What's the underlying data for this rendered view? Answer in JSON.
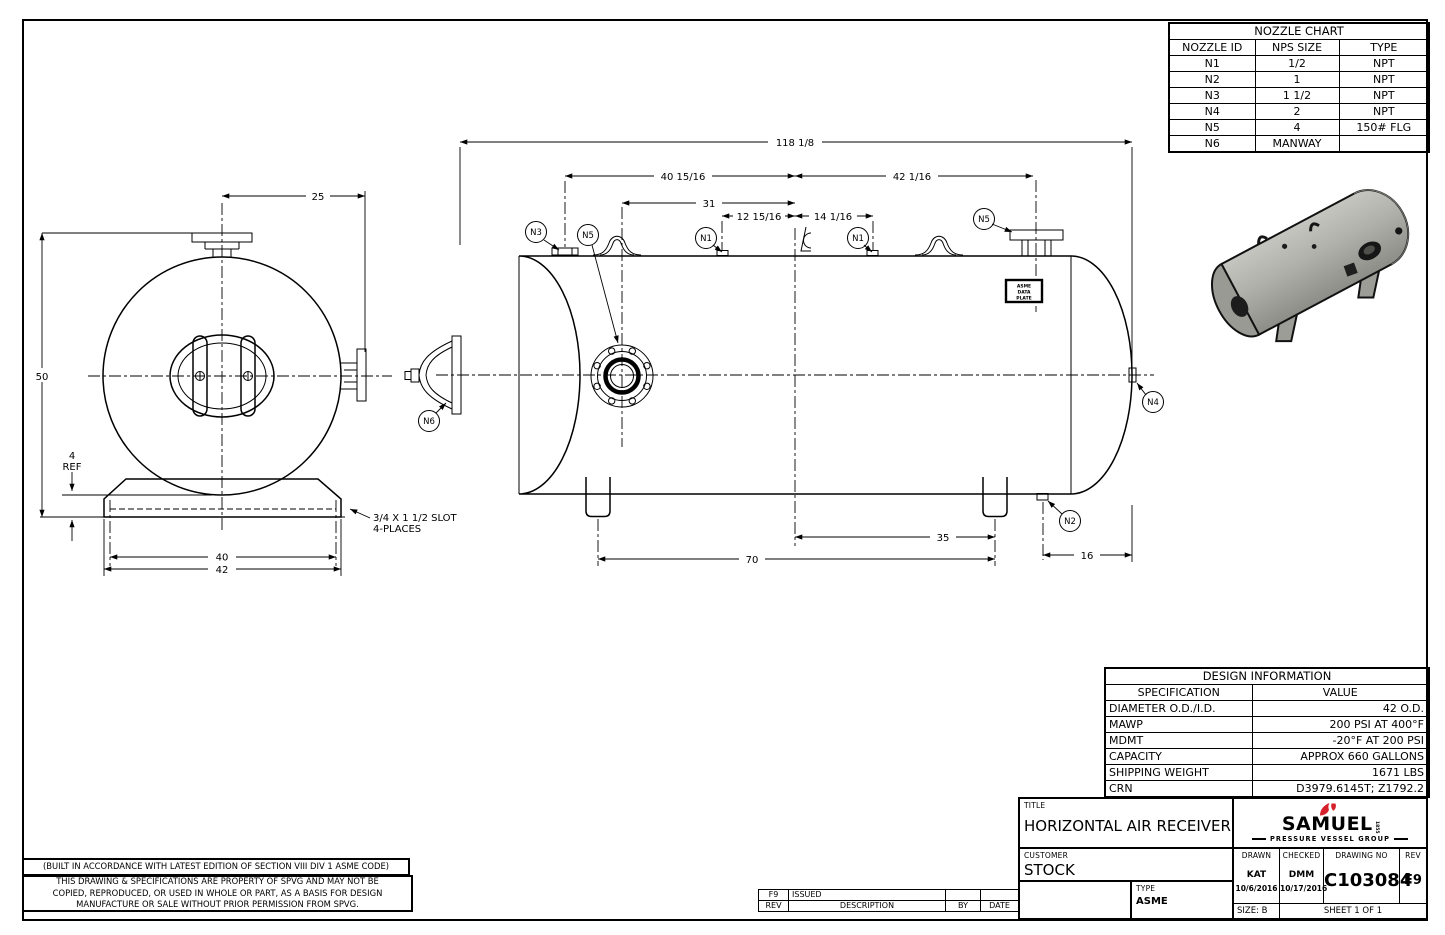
{
  "colors": {
    "brand_red": "#d6202a",
    "tank_gray": "#a6a6a1",
    "line": "#000000"
  },
  "nozzle_chart": {
    "title": "NOZZLE CHART",
    "headers": [
      "NOZZLE ID",
      "NPS SIZE",
      "TYPE"
    ],
    "rows": [
      [
        "N1",
        "1/2",
        "NPT"
      ],
      [
        "N2",
        "1",
        "NPT"
      ],
      [
        "N3",
        "1 1/2",
        "NPT"
      ],
      [
        "N4",
        "2",
        "NPT"
      ],
      [
        "N5",
        "4",
        "150# FLG"
      ],
      [
        "N6",
        "MANWAY",
        ""
      ]
    ]
  },
  "design_info": {
    "title": "DESIGN INFORMATION",
    "headers": [
      "SPECIFICATION",
      "VALUE"
    ],
    "rows": [
      [
        "DIAMETER O.D./I.D.",
        "42 O.D."
      ],
      [
        "MAWP",
        "200 PSI AT 400°F"
      ],
      [
        "MDMT",
        "-20°F AT 200 PSI"
      ],
      [
        "CAPACITY",
        "APPROX 660 GALLONS"
      ],
      [
        "SHIPPING WEIGHT",
        "1671 LBS"
      ],
      [
        "CRN",
        "D3979.6145T; Z1792.2"
      ]
    ]
  },
  "title_block": {
    "title_label": "TITLE",
    "title": "HORIZONTAL AIR RECEIVER",
    "customer_label": "CUSTOMER",
    "customer": "STOCK",
    "type_label": "TYPE",
    "type": "ASME",
    "drawn_label": "DRAWN",
    "drawn_by": "KAT",
    "drawn_date": "10/6/2016",
    "checked_label": "CHECKED",
    "checked_by": "DMM",
    "checked_date": "10/17/2016",
    "drawing_no_label": "DRAWING NO",
    "drawing_no": "C103084",
    "rev_label": "REV",
    "rev": "F9",
    "size": "SIZE: B",
    "sheet": "SHEET 1  OF 1"
  },
  "logo": {
    "name": "SAMUEL",
    "year": "1855",
    "subtitle": "PRESSURE VESSEL GROUP"
  },
  "revision_table": {
    "headers": [
      "REV",
      "DESCRIPTION",
      "BY",
      "DATE"
    ],
    "rows": [
      [
        "F9",
        "ISSUED",
        "",
        ""
      ]
    ]
  },
  "notes": {
    "code_note": "(BUILT IN ACCORDANCE WITH LATEST EDITION OF SECTION VIII DIV 1 ASME CODE)",
    "property_note_1": "THIS DRAWING & SPECIFICATIONS ARE PROPERTY OF SPVG AND MAY NOT BE",
    "property_note_2": "COPIED, REPRODUCED, OR USED IN WHOLE OR PART, AS A BASIS FOR DESIGN",
    "property_note_3": "MANUFACTURE OR SALE WITHOUT PRIOR PERMISSION FROM SPVG."
  },
  "drawing": {
    "end_view": {
      "dim_width_top": "25",
      "dim_height": "50",
      "dim_ref_val": "4",
      "dim_ref_label": "REF",
      "dim_slot_span": "40",
      "dim_base": "42",
      "slot_note_1": "3/4 X 1 1/2 SLOT",
      "slot_note_2": "4-PLACES"
    },
    "side_view": {
      "dim_overall": "118 1/8",
      "dim_left_to_cl": "40 15/16",
      "dim_n5_to_cl": "31",
      "dim_n1l_to_cl": "12 15/16",
      "dim_cl_to_n1r": "14 1/16",
      "dim_cl_to_n5r": "42 1/16",
      "dim_cl_to_saddle": "35",
      "dim_saddle_span": "70",
      "dim_n2_to_end": "16"
    },
    "balloons": {
      "n1": "N1",
      "n2": "N2",
      "n3": "N3",
      "n4": "N4",
      "n5": "N5",
      "n6": "N6"
    },
    "data_plate": [
      "ASME",
      "DATA",
      "PLATE"
    ]
  }
}
